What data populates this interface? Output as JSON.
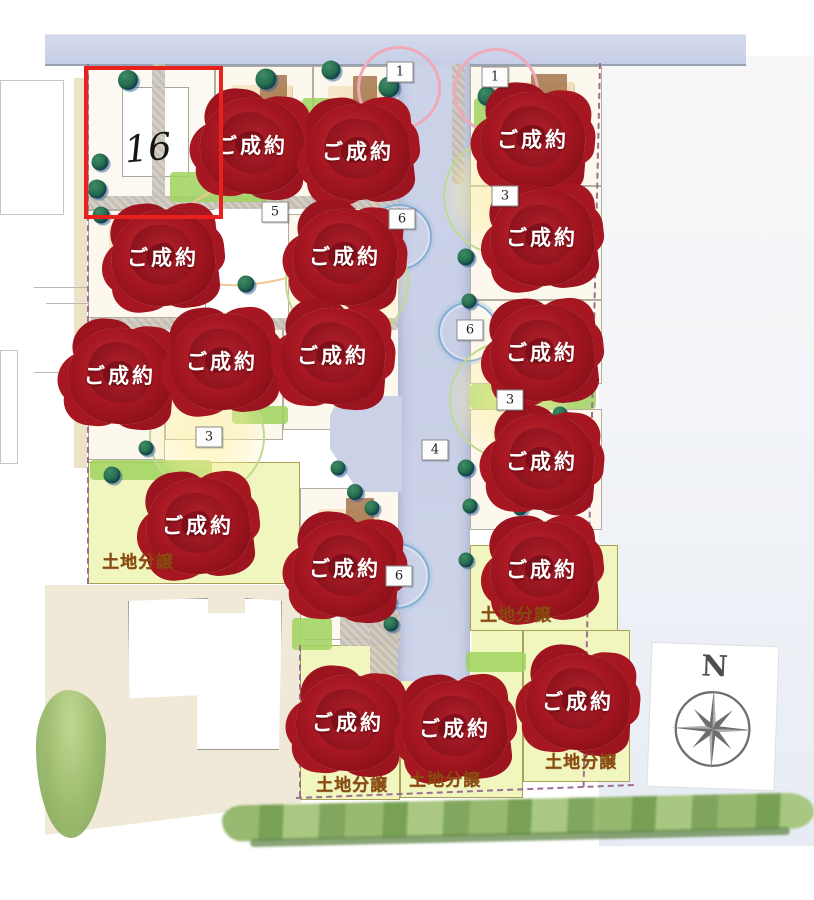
{
  "map": {
    "lot16_label": "16",
    "sold_stamp": "ご成約",
    "land_sale": "土地分譲",
    "compass_n": "N",
    "colors": {
      "road": "#ccd3e9",
      "white_lot": "#fdf8ee",
      "yellow_lot": "#f0f6bd",
      "rose_red": "#a61722",
      "sold_text": "#ffffff",
      "land_label": "#8a4a10",
      "highlight_box": "#e8211d",
      "boundary_dash": "#9b6f92",
      "ring_pink": "#efa9b8",
      "ring_blue": "#85aed4",
      "ring_green": "#c2d98f",
      "ring_orange": "#f2c693",
      "compass_gray": "#6e6e6e"
    },
    "lots": [
      {
        "x": 88,
        "y": 66,
        "w": 127,
        "h": 144,
        "type": "lot16"
      },
      {
        "x": 215,
        "y": 66,
        "w": 98,
        "h": 142,
        "type": "white"
      },
      {
        "x": 313,
        "y": 66,
        "w": 87,
        "h": 148,
        "type": "white"
      },
      {
        "x": 88,
        "y": 210,
        "w": 118,
        "h": 108,
        "type": "white"
      },
      {
        "x": 288,
        "y": 214,
        "w": 112,
        "h": 108,
        "type": "white"
      },
      {
        "x": 88,
        "y": 322,
        "w": 77,
        "h": 138,
        "type": "white"
      },
      {
        "x": 165,
        "y": 322,
        "w": 118,
        "h": 118,
        "type": "white"
      },
      {
        "x": 283,
        "y": 322,
        "w": 117,
        "h": 108,
        "type": "white"
      },
      {
        "x": 88,
        "y": 462,
        "w": 212,
        "h": 122,
        "type": "yellow"
      },
      {
        "x": 300,
        "y": 488,
        "w": 100,
        "h": 152,
        "type": "white"
      },
      {
        "x": 470,
        "y": 66,
        "w": 132,
        "h": 120,
        "type": "white"
      },
      {
        "x": 470,
        "y": 186,
        "w": 132,
        "h": 114,
        "type": "white"
      },
      {
        "x": 470,
        "y": 300,
        "w": 132,
        "h": 84,
        "type": "white"
      },
      {
        "x": 470,
        "y": 409,
        "w": 132,
        "h": 121,
        "type": "white"
      },
      {
        "x": 470,
        "y": 545,
        "w": 148,
        "h": 86,
        "type": "yellow"
      },
      {
        "x": 300,
        "y": 645,
        "w": 100,
        "h": 155,
        "type": "yellow"
      },
      {
        "x": 400,
        "y": 630,
        "w": 123,
        "h": 168,
        "type": "yellow",
        "clip": "polygon(0 30%,58% 30%,58% 0,100% 0,100% 100%,0 100%)"
      },
      {
        "x": 523,
        "y": 630,
        "w": 107,
        "h": 152,
        "type": "yellow"
      }
    ],
    "roses": [
      {
        "x": 252,
        "y": 146,
        "label": "ご成約"
      },
      {
        "x": 358,
        "y": 152,
        "label": "ご成約"
      },
      {
        "x": 533,
        "y": 140,
        "label": "ご成約"
      },
      {
        "x": 163,
        "y": 258,
        "label": "ご成約"
      },
      {
        "x": 345,
        "y": 257,
        "label": "ご成約"
      },
      {
        "x": 542,
        "y": 238,
        "label": "ご成約"
      },
      {
        "x": 120,
        "y": 376,
        "label": "ご成約"
      },
      {
        "x": 222,
        "y": 362,
        "label": "ご成約"
      },
      {
        "x": 333,
        "y": 356,
        "label": "ご成約"
      },
      {
        "x": 542,
        "y": 353,
        "label": "ご成約"
      },
      {
        "x": 542,
        "y": 462,
        "label": "ご成約"
      },
      {
        "x": 198,
        "y": 526,
        "label": "ご成約"
      },
      {
        "x": 345,
        "y": 569,
        "label": "ご成約"
      },
      {
        "x": 542,
        "y": 570,
        "label": "ご成約"
      },
      {
        "x": 348,
        "y": 723,
        "label": "ご成約"
      },
      {
        "x": 455,
        "y": 729,
        "label": "ご成約"
      },
      {
        "x": 578,
        "y": 702,
        "label": "ご成約"
      }
    ],
    "land_labels": [
      {
        "x": 138,
        "y": 560,
        "label": "土地分譲"
      },
      {
        "x": 516,
        "y": 613,
        "label": "土地分譲"
      },
      {
        "x": 352,
        "y": 783,
        "label": "土地分譲"
      },
      {
        "x": 445,
        "y": 778,
        "label": "土地分譲"
      },
      {
        "x": 581,
        "y": 760,
        "label": "土地分譲"
      }
    ],
    "markers": [
      {
        "x": 400,
        "y": 72,
        "label": "1"
      },
      {
        "x": 495,
        "y": 77,
        "label": "1"
      },
      {
        "x": 275,
        "y": 212,
        "label": "5"
      },
      {
        "x": 402,
        "y": 219,
        "label": "6"
      },
      {
        "x": 505,
        "y": 196,
        "label": "3"
      },
      {
        "x": 470,
        "y": 330,
        "label": "6"
      },
      {
        "x": 510,
        "y": 400,
        "label": "3"
      },
      {
        "x": 435,
        "y": 450,
        "label": "4"
      },
      {
        "x": 209,
        "y": 437,
        "label": "3"
      },
      {
        "x": 399,
        "y": 576,
        "label": "6"
      }
    ],
    "rings": [
      {
        "type": "pink",
        "x": 399,
        "y": 88,
        "rx": 39
      },
      {
        "type": "pink",
        "x": 496,
        "y": 91,
        "rx": 40
      },
      {
        "type": "orange",
        "x": 268,
        "y": 228,
        "rx": 108,
        "ry": 52,
        "rot": -13
      },
      {
        "type": "blue",
        "x": 399,
        "y": 237,
        "rx": 31
      },
      {
        "type": "blue",
        "x": 468,
        "y": 332,
        "rx": 28
      },
      {
        "type": "blue",
        "x": 397,
        "y": 576,
        "rx": 31
      },
      {
        "type": "glow",
        "x": 502,
        "y": 196,
        "rx": 57
      },
      {
        "type": "glow",
        "x": 508,
        "y": 400,
        "rx": 57
      },
      {
        "type": "glow",
        "x": 207,
        "y": 437,
        "rx": 56
      },
      {
        "type": "glow",
        "x": 347,
        "y": 282,
        "rx": 60
      }
    ],
    "grass": [
      {
        "x": 170,
        "y": 172,
        "w": 98,
        "h": 30
      },
      {
        "x": 302,
        "y": 98,
        "w": 30,
        "h": 72
      },
      {
        "x": 474,
        "y": 98,
        "w": 16,
        "h": 55
      },
      {
        "x": 470,
        "y": 384,
        "w": 126,
        "h": 25
      },
      {
        "x": 466,
        "y": 652,
        "w": 60,
        "h": 20
      },
      {
        "x": 90,
        "y": 460,
        "w": 122,
        "h": 20
      },
      {
        "x": 292,
        "y": 618,
        "w": 40,
        "h": 32
      },
      {
        "x": 232,
        "y": 406,
        "w": 56,
        "h": 18
      }
    ],
    "concrete": [
      {
        "x": 88,
        "y": 196,
        "w": 310,
        "h": 13
      },
      {
        "x": 90,
        "y": 318,
        "w": 308,
        "h": 12
      },
      {
        "x": 340,
        "y": 612,
        "w": 60,
        "h": 34
      },
      {
        "x": 370,
        "y": 585,
        "w": 28,
        "h": 96
      },
      {
        "x": 152,
        "y": 64,
        "w": 13,
        "h": 134
      },
      {
        "x": 452,
        "y": 64,
        "w": 13,
        "h": 120
      }
    ],
    "trees": [
      {
        "x": 128,
        "y": 80,
        "size": 20
      },
      {
        "x": 266,
        "y": 79,
        "size": 21
      },
      {
        "x": 331,
        "y": 70,
        "size": 19
      },
      {
        "x": 389,
        "y": 87,
        "size": 21
      },
      {
        "x": 487,
        "y": 96,
        "size": 19
      },
      {
        "x": 558,
        "y": 102,
        "size": 19
      },
      {
        "x": 100,
        "y": 162,
        "size": 17
      },
      {
        "x": 97,
        "y": 189,
        "size": 19
      },
      {
        "x": 101,
        "y": 215,
        "size": 17
      },
      {
        "x": 246,
        "y": 284,
        "size": 17
      },
      {
        "x": 466,
        "y": 257,
        "size": 17
      },
      {
        "x": 469,
        "y": 301,
        "size": 15
      },
      {
        "x": 226,
        "y": 392,
        "size": 17
      },
      {
        "x": 352,
        "y": 398,
        "size": 16
      },
      {
        "x": 368,
        "y": 390,
        "size": 15
      },
      {
        "x": 540,
        "y": 419,
        "size": 17
      },
      {
        "x": 560,
        "y": 414,
        "size": 15
      },
      {
        "x": 338,
        "y": 468,
        "size": 15
      },
      {
        "x": 355,
        "y": 492,
        "size": 16
      },
      {
        "x": 372,
        "y": 508,
        "size": 15
      },
      {
        "x": 466,
        "y": 468,
        "size": 17
      },
      {
        "x": 470,
        "y": 506,
        "size": 15
      },
      {
        "x": 520,
        "y": 508,
        "size": 15
      },
      {
        "x": 392,
        "y": 548,
        "size": 17
      },
      {
        "x": 388,
        "y": 602,
        "size": 17
      },
      {
        "x": 391,
        "y": 624,
        "size": 15
      },
      {
        "x": 160,
        "y": 566,
        "size": 15
      },
      {
        "x": 466,
        "y": 560,
        "size": 15
      },
      {
        "x": 112,
        "y": 475,
        "size": 17
      },
      {
        "x": 146,
        "y": 448,
        "size": 15
      }
    ],
    "neighbors": [
      {
        "x": 0,
        "y": 80,
        "w": 62,
        "h": 133,
        "type": "outline"
      },
      {
        "x": 0,
        "y": 350,
        "w": 16,
        "h": 112,
        "type": "outline"
      },
      {
        "x": 74,
        "y": 78,
        "w": 13,
        "h": 390,
        "type": "beige"
      },
      {
        "x": 34,
        "y": 287,
        "w": 54,
        "h": 1,
        "type": "line"
      },
      {
        "x": 46,
        "y": 303,
        "w": 42,
        "h": 1,
        "type": "line"
      },
      {
        "x": 34,
        "y": 372,
        "w": 54,
        "h": 1,
        "type": "line"
      }
    ]
  }
}
